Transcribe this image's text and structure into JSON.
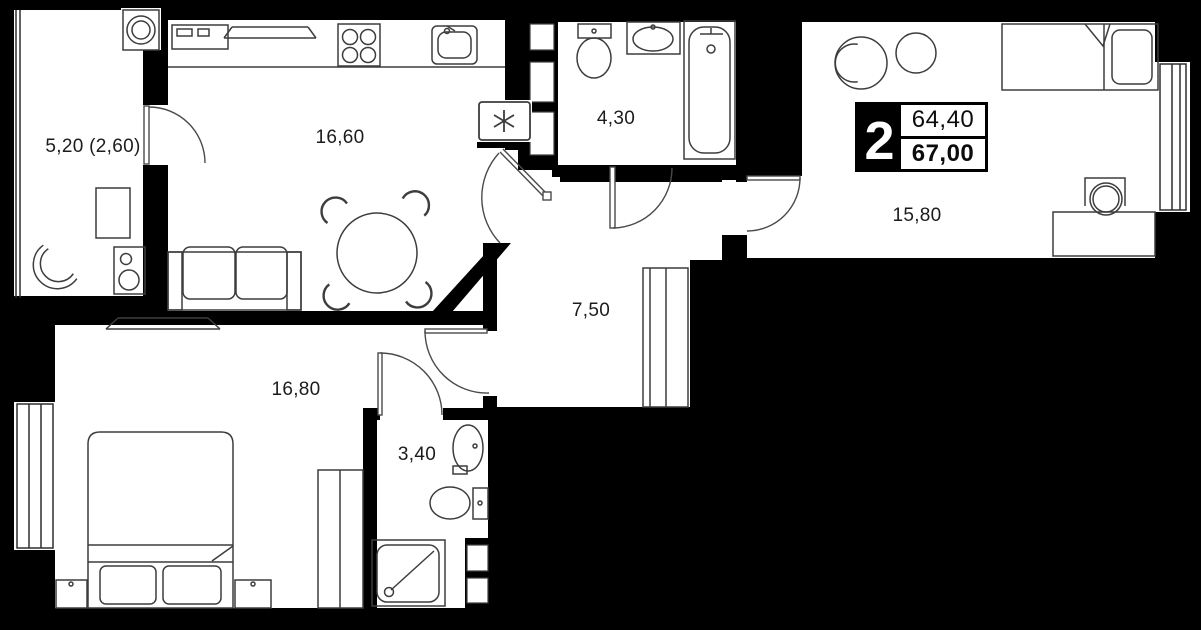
{
  "plan": {
    "type": "apartment-floor-plan",
    "colors": {
      "background": "#000000",
      "floor": "#ffffff",
      "walls": "#000000",
      "furniture_lines": "#3d3d3d",
      "labels": "#1c1c1c"
    }
  },
  "badge": {
    "rooms_count": "2",
    "area_living": "64,40",
    "area_total": "67,00"
  },
  "rooms": [
    {
      "id": "balcony",
      "label": "5,20 (2,60)",
      "furniture": [
        "washing-machine-icon",
        "balcony-table-icon",
        "round-chair-icon",
        "speaker-icon"
      ]
    },
    {
      "id": "kitchen-living",
      "label": "16,60",
      "furniture": [
        "microwave-icon",
        "tv-icon",
        "stove-icon",
        "kitchen-sink-icon",
        "dining-table-icon",
        "chair-icon",
        "sofa-icon",
        "appliance-asterisk-icon"
      ]
    },
    {
      "id": "bathroom",
      "label": "4,30",
      "furniture": [
        "toilet-icon",
        "bathroom-sink-icon",
        "bathtub-icon"
      ]
    },
    {
      "id": "hallway",
      "label": "7,50",
      "furniture": [
        "closet-icon"
      ]
    },
    {
      "id": "bedroom-right",
      "label": "15,80",
      "furniture": [
        "armchair-icon",
        "pouf-icon",
        "single-bed-icon",
        "desk-icon",
        "desk-chair-icon",
        "window-icon"
      ]
    },
    {
      "id": "bedroom-left",
      "label": "16,80",
      "furniture": [
        "tv-icon",
        "double-bed-icon",
        "pillow-icon",
        "nightstand-icon",
        "wardrobe-icon",
        "window-icon"
      ]
    },
    {
      "id": "bathroom-small",
      "label": "3,40",
      "furniture": [
        "bathroom-sink-icon",
        "toilet-icon",
        "shower-icon",
        "vent-shaft-icon"
      ]
    }
  ]
}
